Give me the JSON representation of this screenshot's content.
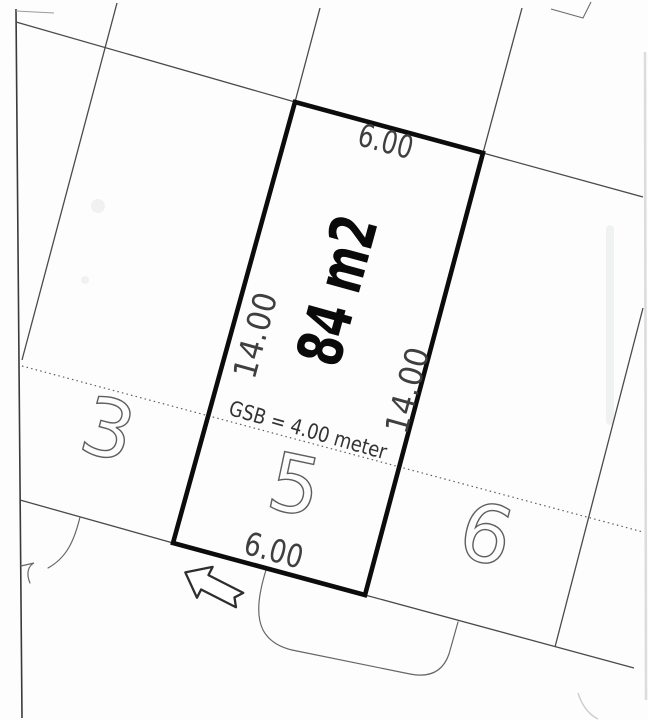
{
  "plot": {
    "number": "5",
    "area_label": "84 m2",
    "width_top": "6.00",
    "width_bottom": "6.00",
    "depth_left": "14.00",
    "depth_right": "14.00",
    "setback_note": "GSB = 4.00 meter"
  },
  "adjacent_plots": {
    "left": "3",
    "right": "6"
  },
  "icons": {
    "entrance_arrow": "block-arrow-pointing-upper-left"
  },
  "colors": {
    "plot_outline": "#0c0c0c",
    "parcel_line": "#4a4a4a",
    "dimension_text": "#3f3f3f",
    "area_text": "#0a0a0a",
    "parcel_number_text": "#5e5e5e",
    "paper": "#fdfdfd"
  }
}
